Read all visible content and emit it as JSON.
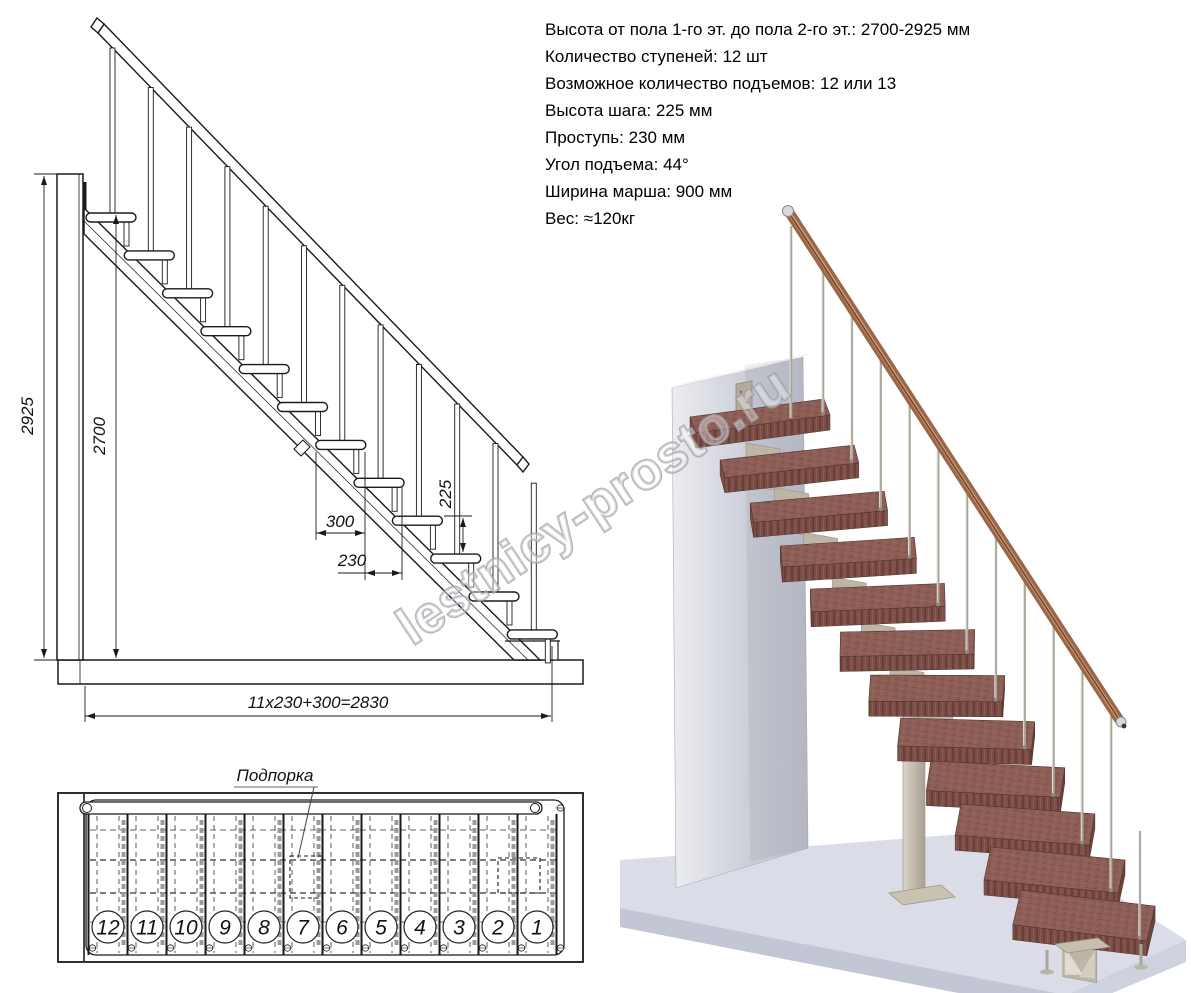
{
  "specs": {
    "lines": [
      "Высота от пола 1-го эт. до пола 2-го эт.: 2700-2925 мм",
      "Количество ступеней: 12 шт",
      "Возможное количество подъемов: 12 или 13",
      "Высота шага: 225 мм",
      "Проступь: 230 мм",
      "Угол подъема: 44°",
      "Ширина марша: 900 мм",
      "Вес: ≈120кг"
    ]
  },
  "side_view": {
    "dim_height_overall": "2925",
    "dim_height_floor": "2700",
    "dim_tread_depth": "300",
    "dim_going": "230",
    "dim_riser": "225",
    "dim_total_run": "11x230+300=2830",
    "steps_count": 12
  },
  "plan_view": {
    "label_support": "Подпорка",
    "step_numbers": [
      "12",
      "11",
      "10",
      "9",
      "8",
      "7",
      "6",
      "5",
      "4",
      "3",
      "2",
      "1"
    ]
  },
  "watermark": {
    "text": "lestnicy-prosto.ru"
  },
  "colors": {
    "line": "#1a1a1a",
    "tread_wood": "#8d5f57",
    "tread_front": "#7b4f47",
    "handrail_copper": "#9b6647",
    "metal_spine": "#bdb6a7",
    "baluster_metal": "#a9a599",
    "wall_gray": "#c9cbd4",
    "floor_gray": "#dadce8",
    "watermark_gray": "#9d9da6"
  }
}
